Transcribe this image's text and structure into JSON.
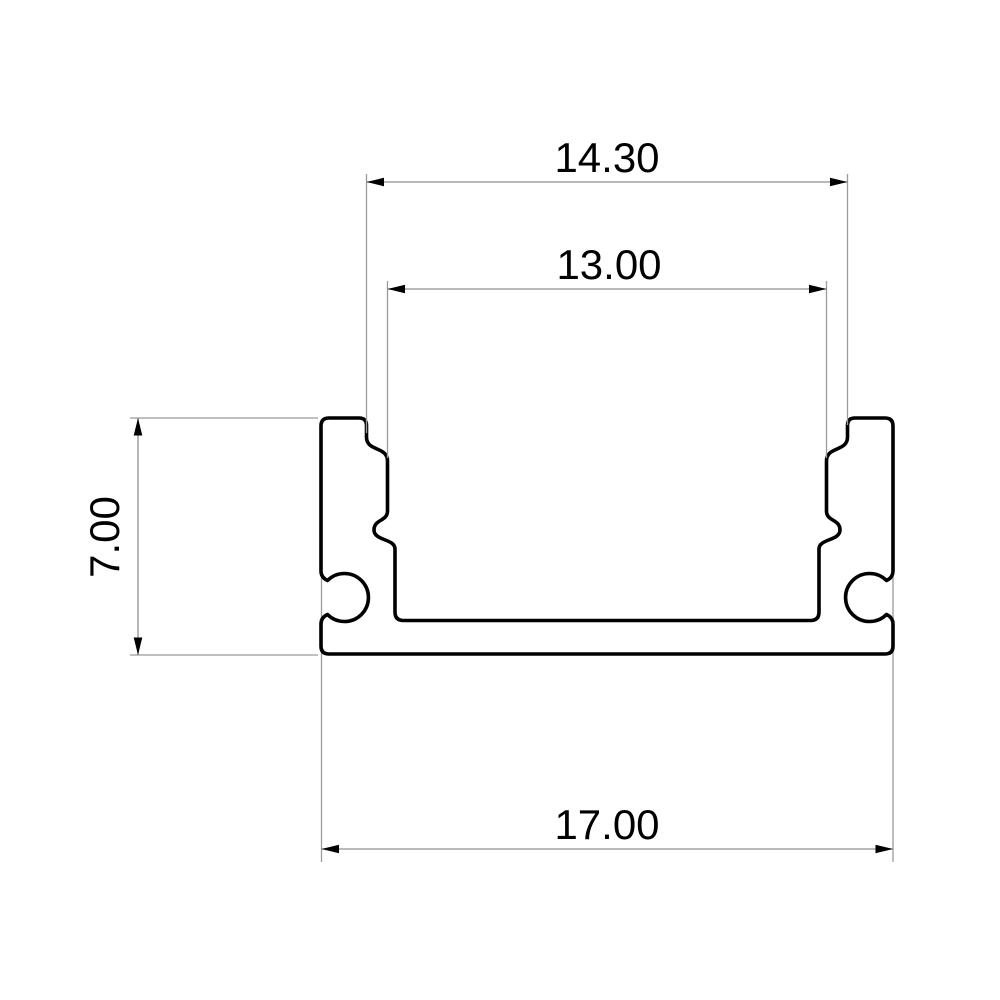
{
  "drawing": {
    "type": "technical-cross-section-profile",
    "dimensions": {
      "top_outer": {
        "label": "14.30",
        "value": 14.3
      },
      "inner_width": {
        "label": "13.00",
        "value": 13.0
      },
      "height": {
        "label": "7.00",
        "value": 7.0
      },
      "bottom_width": {
        "label": "17.00",
        "value": 17.0
      }
    }
  },
  "colors": {
    "background": "#ffffff",
    "profile_stroke": "#000000",
    "profile_fill": "#ffffff",
    "dimension_line": "#8f8f8f",
    "extension_line": "#9b9b9b",
    "arrow": "#000000",
    "text": "#000000"
  }
}
